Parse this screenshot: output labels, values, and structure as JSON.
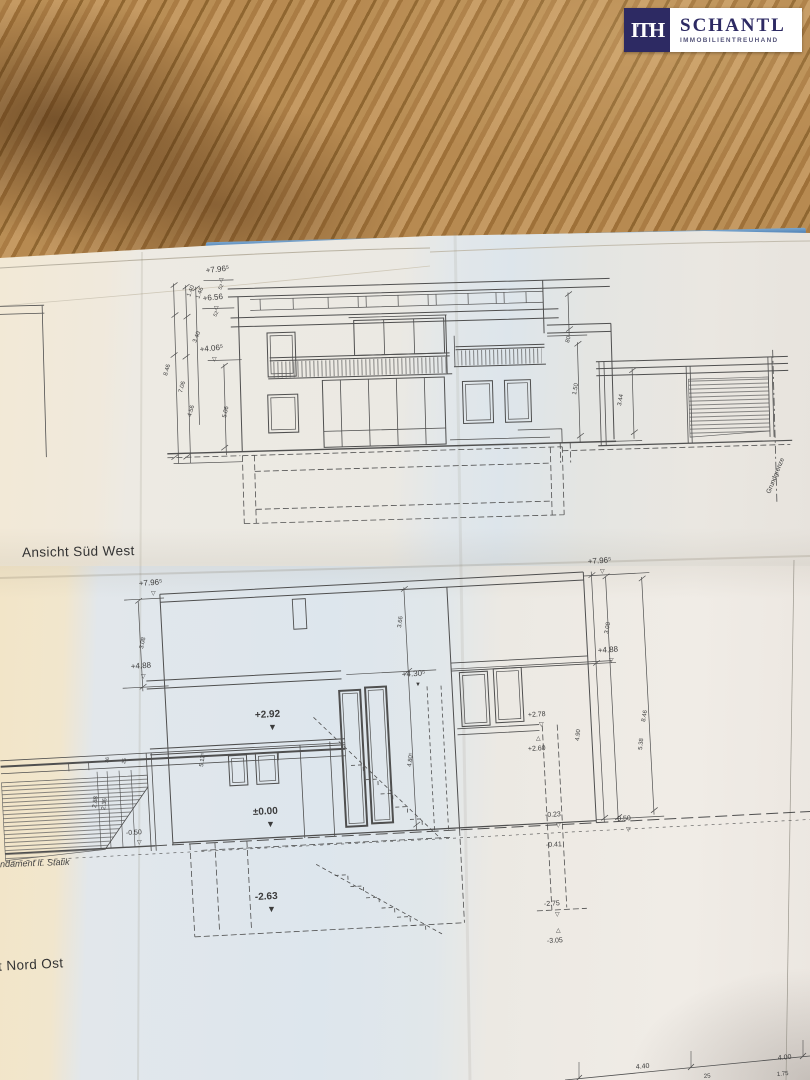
{
  "branding": {
    "logo_monogram": "ITH",
    "logo_name": "SCHANTL",
    "logo_subtitle": "IMMOBILIENTREUHAND"
  },
  "palette": {
    "navy": "#2d2a63",
    "folder_blue": "#336aa6",
    "wood_base": "#ab7d49",
    "paper_cream": "#f1e6cd",
    "paper_blue": "#dde6ed",
    "paper_white": "#eeeae4",
    "line": "#4f4f4f"
  },
  "drawings": {
    "upper": {
      "title": "Ansicht Süd West",
      "annotations": [
        {
          "t": "+7.96⁵",
          "x": 206,
          "y": 273,
          "r": -6,
          "s": 8
        },
        {
          "t": "▽",
          "x": 219,
          "y": 282,
          "r": 0,
          "s": 6
        },
        {
          "t": "52",
          "x": 221,
          "y": 290,
          "r": -62,
          "s": 5
        },
        {
          "t": "+6.56",
          "x": 203,
          "y": 301,
          "r": -6,
          "s": 8
        },
        {
          "t": "▽",
          "x": 214,
          "y": 310,
          "r": 0,
          "s": 6
        },
        {
          "t": "52",
          "x": 216,
          "y": 317,
          "r": -62,
          "s": 5
        },
        {
          "t": "+4.06⁵",
          "x": 200,
          "y": 352,
          "r": -6,
          "s": 8
        },
        {
          "t": "▽",
          "x": 212,
          "y": 361,
          "r": 0,
          "s": 6
        },
        {
          "t": "1.40",
          "x": 190,
          "y": 297,
          "r": -68,
          "s": 6
        },
        {
          "t": "1.46",
          "x": 199,
          "y": 299,
          "r": -68,
          "s": 6
        },
        {
          "t": "3.40",
          "x": 196,
          "y": 343,
          "r": -68,
          "s": 6
        },
        {
          "t": "8.46",
          "x": 167,
          "y": 376,
          "r": -74,
          "s": 6
        },
        {
          "t": "7.06",
          "x": 182,
          "y": 393,
          "r": -74,
          "s": 6
        },
        {
          "t": "4.56",
          "x": 191,
          "y": 417,
          "r": -74,
          "s": 6
        },
        {
          "t": "5.06",
          "x": 226,
          "y": 418,
          "r": -78,
          "s": 6
        },
        {
          "t": "80",
          "x": 569,
          "y": 343,
          "r": -76,
          "s": 6
        },
        {
          "t": "1.50",
          "x": 576,
          "y": 395,
          "r": -80,
          "s": 6
        },
        {
          "t": "3.44",
          "x": 621,
          "y": 406,
          "r": -80,
          "s": 6
        },
        {
          "t": "Grundgrenze",
          "x": 770,
          "y": 494,
          "r": -68,
          "s": 6.5
        }
      ]
    },
    "lower": {
      "title_partial": "t Nord Ost",
      "note_partial": "ndament lt. Statik",
      "annotations": [
        {
          "t": "+7.96⁵",
          "x": 139,
          "y": 586,
          "r": -4,
          "s": 8
        },
        {
          "t": "▽",
          "x": 151,
          "y": 595,
          "r": 0,
          "s": 6
        },
        {
          "t": "3.08",
          "x": 143,
          "y": 649,
          "r": -78,
          "s": 6
        },
        {
          "t": "+4.88",
          "x": 131,
          "y": 669,
          "r": -4,
          "s": 8
        },
        {
          "t": "▽",
          "x": 141,
          "y": 678,
          "r": 0,
          "s": 6
        },
        {
          "t": "+7.96⁵",
          "x": 588,
          "y": 564,
          "r": -4,
          "s": 8
        },
        {
          "t": "▽",
          "x": 600,
          "y": 573,
          "r": 0,
          "s": 6
        },
        {
          "t": "3.08",
          "x": 608,
          "y": 634,
          "r": -80,
          "s": 6
        },
        {
          "t": "+4.88",
          "x": 598,
          "y": 653,
          "r": -4,
          "s": 8
        },
        {
          "t": "▽",
          "x": 609,
          "y": 662,
          "r": 0,
          "s": 6
        },
        {
          "t": "3.66",
          "x": 401,
          "y": 628,
          "r": -82,
          "s": 6
        },
        {
          "t": "+4.30⁵",
          "x": 402,
          "y": 677,
          "r": -4,
          "s": 8
        },
        {
          "t": "▼",
          "x": 415,
          "y": 686,
          "r": 0,
          "s": 6
        },
        {
          "t": "+2.92",
          "x": 255,
          "y": 718,
          "r": -3,
          "s": 10,
          "b": 1
        },
        {
          "t": "▼",
          "x": 268,
          "y": 730,
          "r": 0,
          "s": 9
        },
        {
          "t": "±0.00",
          "x": 253,
          "y": 815,
          "r": -3,
          "s": 10,
          "b": 1
        },
        {
          "t": "▼",
          "x": 266,
          "y": 827,
          "r": 0,
          "s": 9
        },
        {
          "t": "-2.63",
          "x": 255,
          "y": 900,
          "r": -3,
          "s": 10,
          "b": 1
        },
        {
          "t": "▼",
          "x": 267,
          "y": 912,
          "r": 0,
          "s": 9
        },
        {
          "t": "5.12⁵",
          "x": 203,
          "y": 767,
          "r": -82,
          "s": 6
        },
        {
          "t": "4.80⁵",
          "x": 411,
          "y": 767,
          "r": -82,
          "s": 6
        },
        {
          "t": "4.90",
          "x": 579,
          "y": 741,
          "r": -84,
          "s": 6
        },
        {
          "t": "5.38",
          "x": 642,
          "y": 750,
          "r": -84,
          "s": 6
        },
        {
          "t": "8.46",
          "x": 645,
          "y": 722,
          "r": -80,
          "s": 6
        },
        {
          "t": "2.88",
          "x": 96,
          "y": 808,
          "r": -82,
          "s": 6
        },
        {
          "t": "2.36",
          "x": 105,
          "y": 810,
          "r": -82,
          "s": 6
        },
        {
          "t": "36",
          "x": 108,
          "y": 763,
          "r": -78,
          "s": 5
        },
        {
          "t": "25",
          "x": 125,
          "y": 764,
          "r": -78,
          "s": 5
        },
        {
          "t": "-0.50",
          "x": 126,
          "y": 835,
          "r": -3,
          "s": 7
        },
        {
          "t": "▽",
          "x": 137,
          "y": 844,
          "r": 0,
          "s": 6
        },
        {
          "t": "+2.78",
          "x": 528,
          "y": 717,
          "r": -3,
          "s": 7
        },
        {
          "t": "▽",
          "x": 539,
          "y": 726,
          "r": 0,
          "s": 6
        },
        {
          "t": "△",
          "x": 536,
          "y": 740,
          "r": 0,
          "s": 6
        },
        {
          "t": "+2.60",
          "x": 528,
          "y": 751,
          "r": -3,
          "s": 7
        },
        {
          "t": "-0.23",
          "x": 545,
          "y": 817,
          "r": -3,
          "s": 7
        },
        {
          "t": "▽",
          "x": 556,
          "y": 827,
          "r": 0,
          "s": 6
        },
        {
          "t": "-0.50",
          "x": 615,
          "y": 821,
          "r": -3,
          "s": 7
        },
        {
          "t": "▽",
          "x": 626,
          "y": 831,
          "r": 0,
          "s": 6
        },
        {
          "t": "-0.41",
          "x": 546,
          "y": 847,
          "r": -3,
          "s": 7
        },
        {
          "t": "-2.75",
          "x": 544,
          "y": 906,
          "r": -3,
          "s": 7
        },
        {
          "t": "▽",
          "x": 555,
          "y": 916,
          "r": 0,
          "s": 6
        },
        {
          "t": "△",
          "x": 556,
          "y": 932,
          "r": 0,
          "s": 6
        },
        {
          "t": "-3.05",
          "x": 547,
          "y": 943,
          "r": -3,
          "s": 7
        },
        {
          "t": "4.40",
          "x": 636,
          "y": 1069,
          "r": -5,
          "s": 7
        },
        {
          "t": "4.00",
          "x": 778,
          "y": 1060,
          "r": -5,
          "s": 7
        },
        {
          "t": "25",
          "x": 704,
          "y": 1078,
          "r": -5,
          "s": 6
        },
        {
          "t": "1.75",
          "x": 777,
          "y": 1076,
          "r": -5,
          "s": 6
        }
      ]
    }
  }
}
